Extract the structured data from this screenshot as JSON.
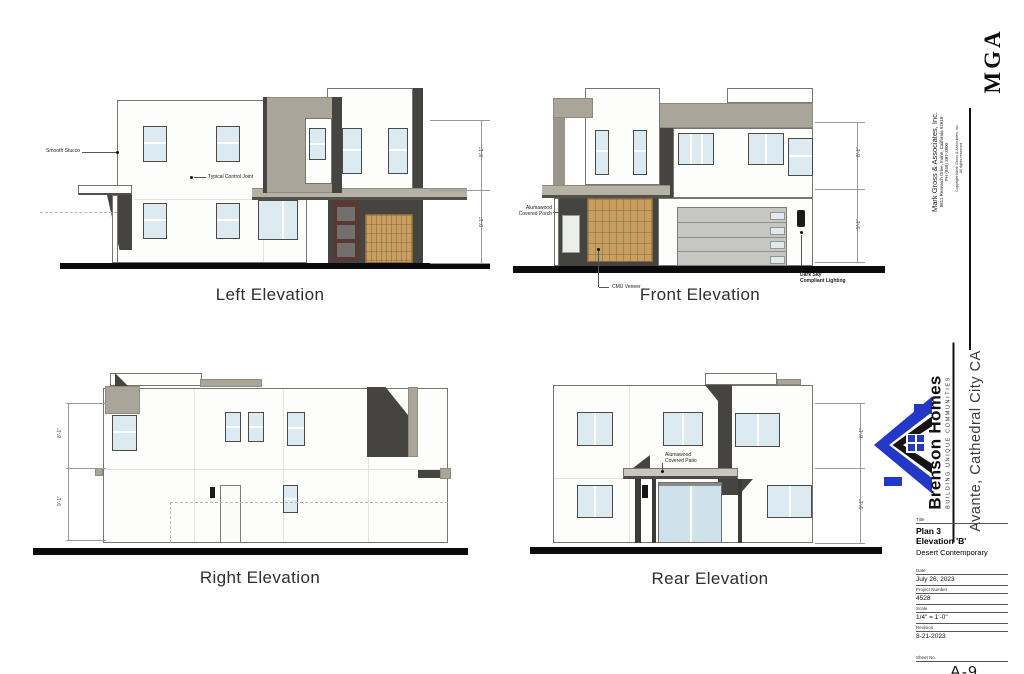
{
  "colors": {
    "brand_blue": "#2438c8",
    "taupe": "#a9a598",
    "charcoal": "#454440",
    "wood_tan": "#c89f63"
  },
  "elevations": {
    "left": {
      "title": "Left Elevation",
      "label_smooth_stucco": "Smooth Stucco",
      "label_control_joint": "Typical Control Joint",
      "dim_upper": "8'-1\"",
      "dim_lower": "9'-1\""
    },
    "front": {
      "title": "Front Elevation",
      "label_porch_line1": "Alumawood",
      "label_porch_line2": "Covered Porch",
      "label_cmu": "CMU Veneer",
      "label_lighting_line1": "Dark Sky",
      "label_lighting_line2": "Compliant Lighting",
      "dim_upper": "8'-1\"",
      "dim_lower": "9'-1\""
    },
    "right": {
      "title": "Right Elevation",
      "dim_upper": "8'-1\"",
      "dim_lower": "9'-1\""
    },
    "rear": {
      "title": "Rear Elevation",
      "label_patio_line1": "Alumawood",
      "label_patio_line2": "Covered Patio",
      "dim_upper": "8'-1\"",
      "dim_lower": "9'-1\""
    }
  },
  "architect": {
    "logo": "MGA",
    "name": "Mark Gross & Associates, Inc.",
    "address": "8811 Research Drive, Irvine, California  92618",
    "phone": "PH (949) 387-3800",
    "copyright_line1": "Copyright Mark Gross & Associates, Inc.",
    "copyright_line2": "All rights reserved"
  },
  "builder": {
    "name": "Brenson Homes",
    "tagline": "BUILDING UNIQUE COMMUNITIES",
    "project": "Avante, Cathedral City CA"
  },
  "titleblock": {
    "title_label": "Title",
    "plan": "Plan 3",
    "elevation": "Elevation 'B'",
    "style": "Desert Contemporary",
    "date_label": "Date",
    "date": "July 26, 2023",
    "project_number_label": "Project Number",
    "project_number": "4528",
    "scale_label": "Scale",
    "scale": "1/4\" = 1'-0\"",
    "revision_label": "Revision",
    "revision": "8-21-2023",
    "sheet_label": "Sheet No.",
    "sheet_number": "A-9",
    "print_date": "May 17, 2024"
  }
}
